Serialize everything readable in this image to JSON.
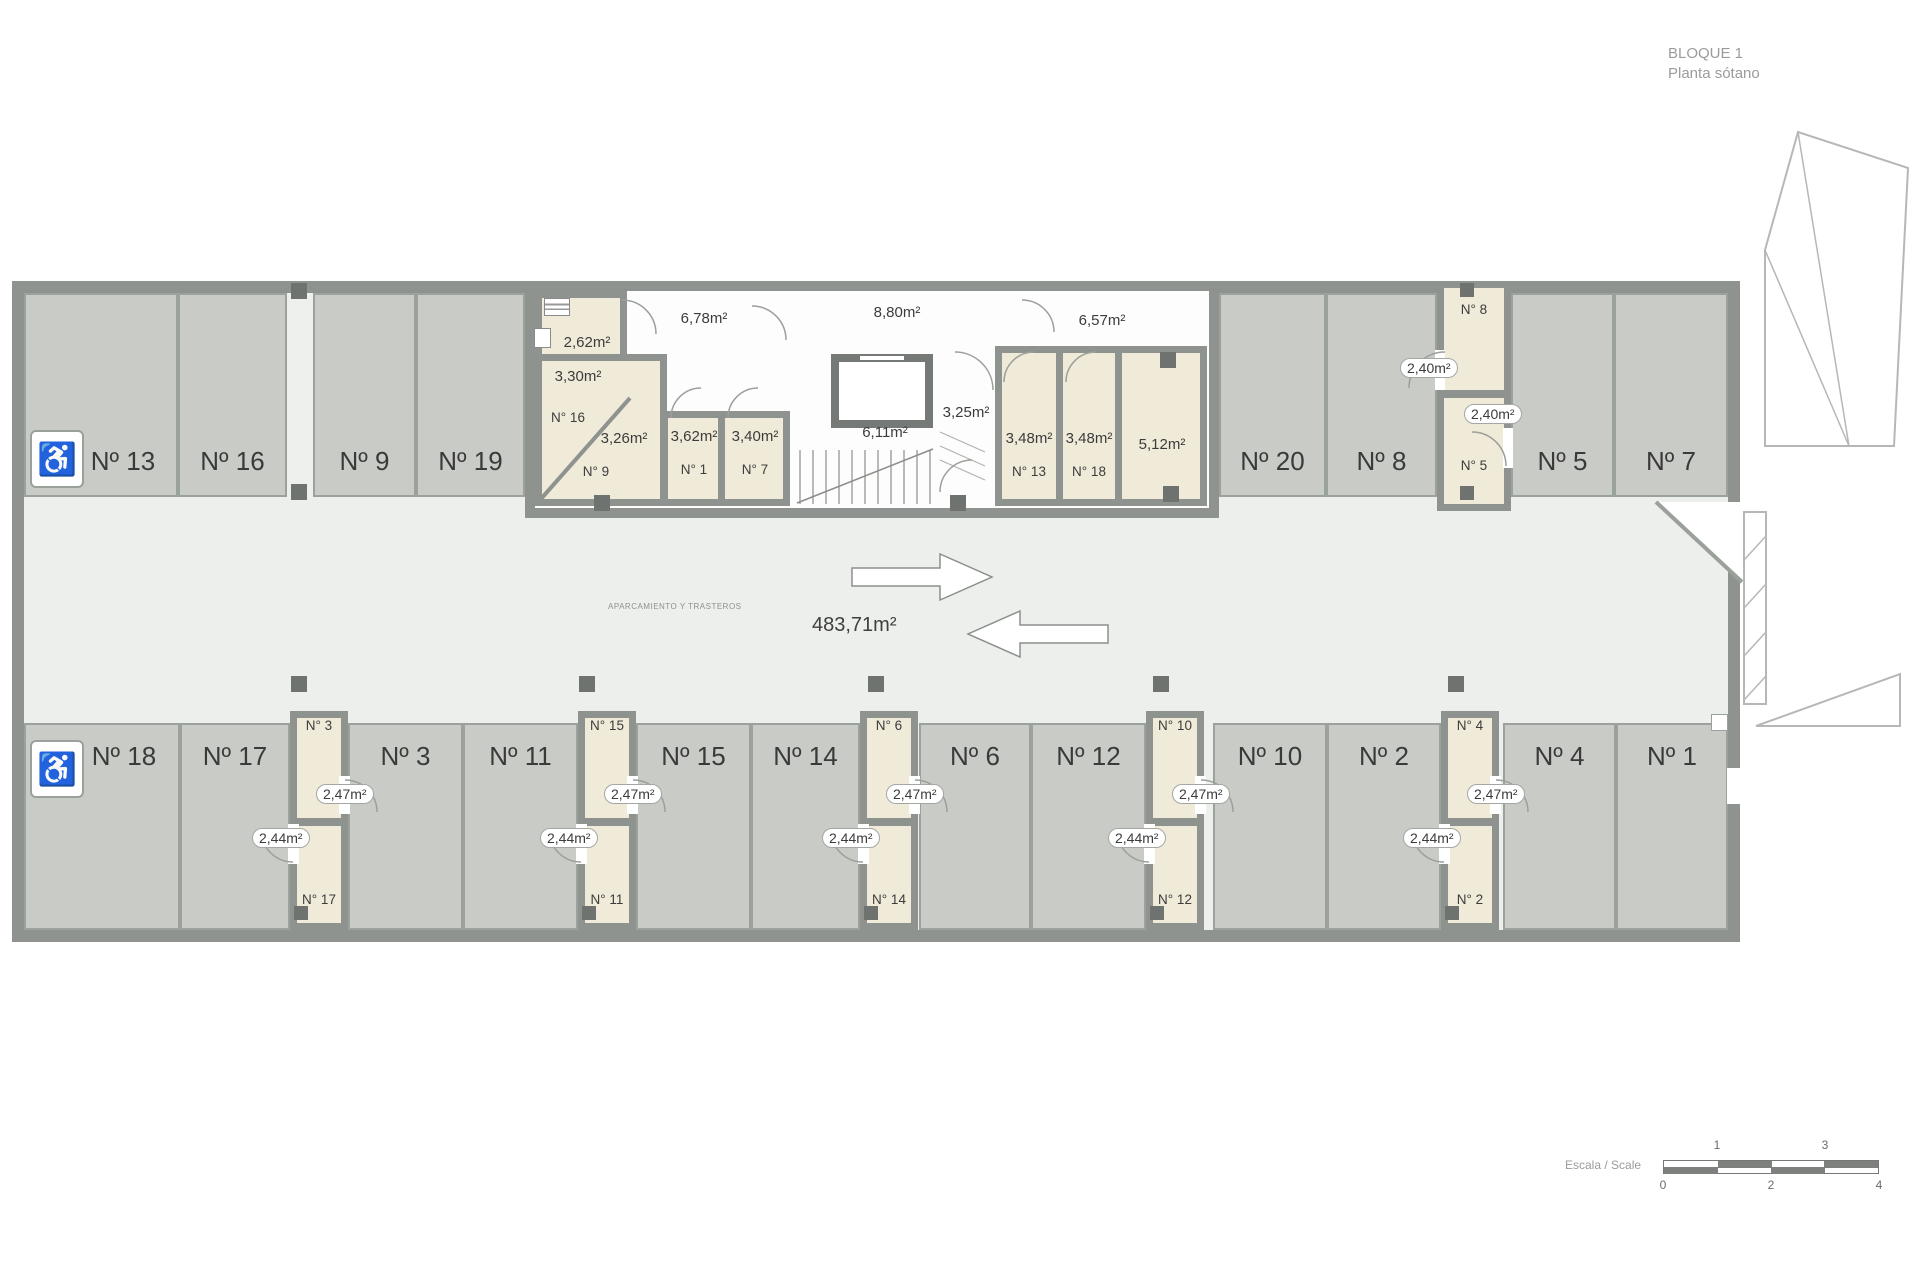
{
  "title": {
    "line1": "BLOQUE 1",
    "line2": "Planta sótano"
  },
  "aisle": {
    "area": "483,71m²",
    "caption": "APARCAMIENTO Y TRASTEROS"
  },
  "top_parking": [
    {
      "label": "Nº 13"
    },
    {
      "label": "Nº 16"
    },
    {
      "label": "Nº 9"
    },
    {
      "label": "Nº 19"
    },
    {
      "label": "Nº 20"
    },
    {
      "label": "Nº 8"
    },
    {
      "label": "Nº 5"
    },
    {
      "label": "Nº 7"
    }
  ],
  "bottom_parking": [
    {
      "label": "Nº 18"
    },
    {
      "label": "Nº 17"
    },
    {
      "label": "Nº 3"
    },
    {
      "label": "Nº 11"
    },
    {
      "label": "Nº 15"
    },
    {
      "label": "Nº 14"
    },
    {
      "label": "Nº 6"
    },
    {
      "label": "Nº 12"
    },
    {
      "label": "Nº 10"
    },
    {
      "label": "Nº 2"
    },
    {
      "label": "Nº 4"
    },
    {
      "label": "Nº 1"
    }
  ],
  "central_block": {
    "room_262": {
      "area": "2,62m²"
    },
    "room_330": {
      "area": "3,30m²",
      "name": "N° 16"
    },
    "room_326": {
      "area": "3,26m²",
      "name": "N° 9"
    },
    "corridor_678": {
      "area": "6,78m²"
    },
    "room_362": {
      "area": "3,62m²",
      "name": "N° 1"
    },
    "room_340": {
      "area": "3,40m²",
      "name": "N° 7"
    },
    "corridor_880": {
      "area": "8,80m²"
    },
    "stairs": {
      "area": "6,11m²"
    },
    "lobby_325": {
      "area": "3,25m²"
    },
    "corridor_657": {
      "area": "6,57m²"
    },
    "room_348a": {
      "area": "3,48m²",
      "name": "N° 13"
    },
    "room_348b": {
      "area": "3,48m²",
      "name": "N° 18"
    },
    "room_512": {
      "area": "5,12m²"
    }
  },
  "right_column": {
    "top_name": "N° 8",
    "top_area": "2,40m²",
    "bottom_area": "2,40m²",
    "bottom_name": "N° 5"
  },
  "bottom_columns": [
    {
      "top_name": "N° 3",
      "top_area": "2,47m²",
      "bottom_area": "2,44m²",
      "bottom_name": "N° 17"
    },
    {
      "top_name": "N° 15",
      "top_area": "2,47m²",
      "bottom_area": "2,44m²",
      "bottom_name": "N° 11"
    },
    {
      "top_name": "N° 6",
      "top_area": "2,47m²",
      "bottom_area": "2,44m²",
      "bottom_name": "N° 14"
    },
    {
      "top_name": "N° 10",
      "top_area": "2,47m²",
      "bottom_area": "2,44m²",
      "bottom_name": "N° 12"
    },
    {
      "top_name": "N° 4",
      "top_area": "2,47m²",
      "bottom_area": "2,44m²",
      "bottom_name": "N° 2"
    }
  ],
  "icons": {
    "handicap": "♿"
  },
  "scalebar": {
    "label": "Escala / Scale",
    "above": [
      "1",
      "3"
    ],
    "below": [
      "0",
      "2",
      "4"
    ]
  },
  "colors": {
    "parking_fill": "#c9cbc7",
    "aisle_fill": "#edefec",
    "storage_fill": "#f0ead8",
    "wall": "#8f938f",
    "pillar": "#6f736f",
    "line": "#9aa09a"
  }
}
